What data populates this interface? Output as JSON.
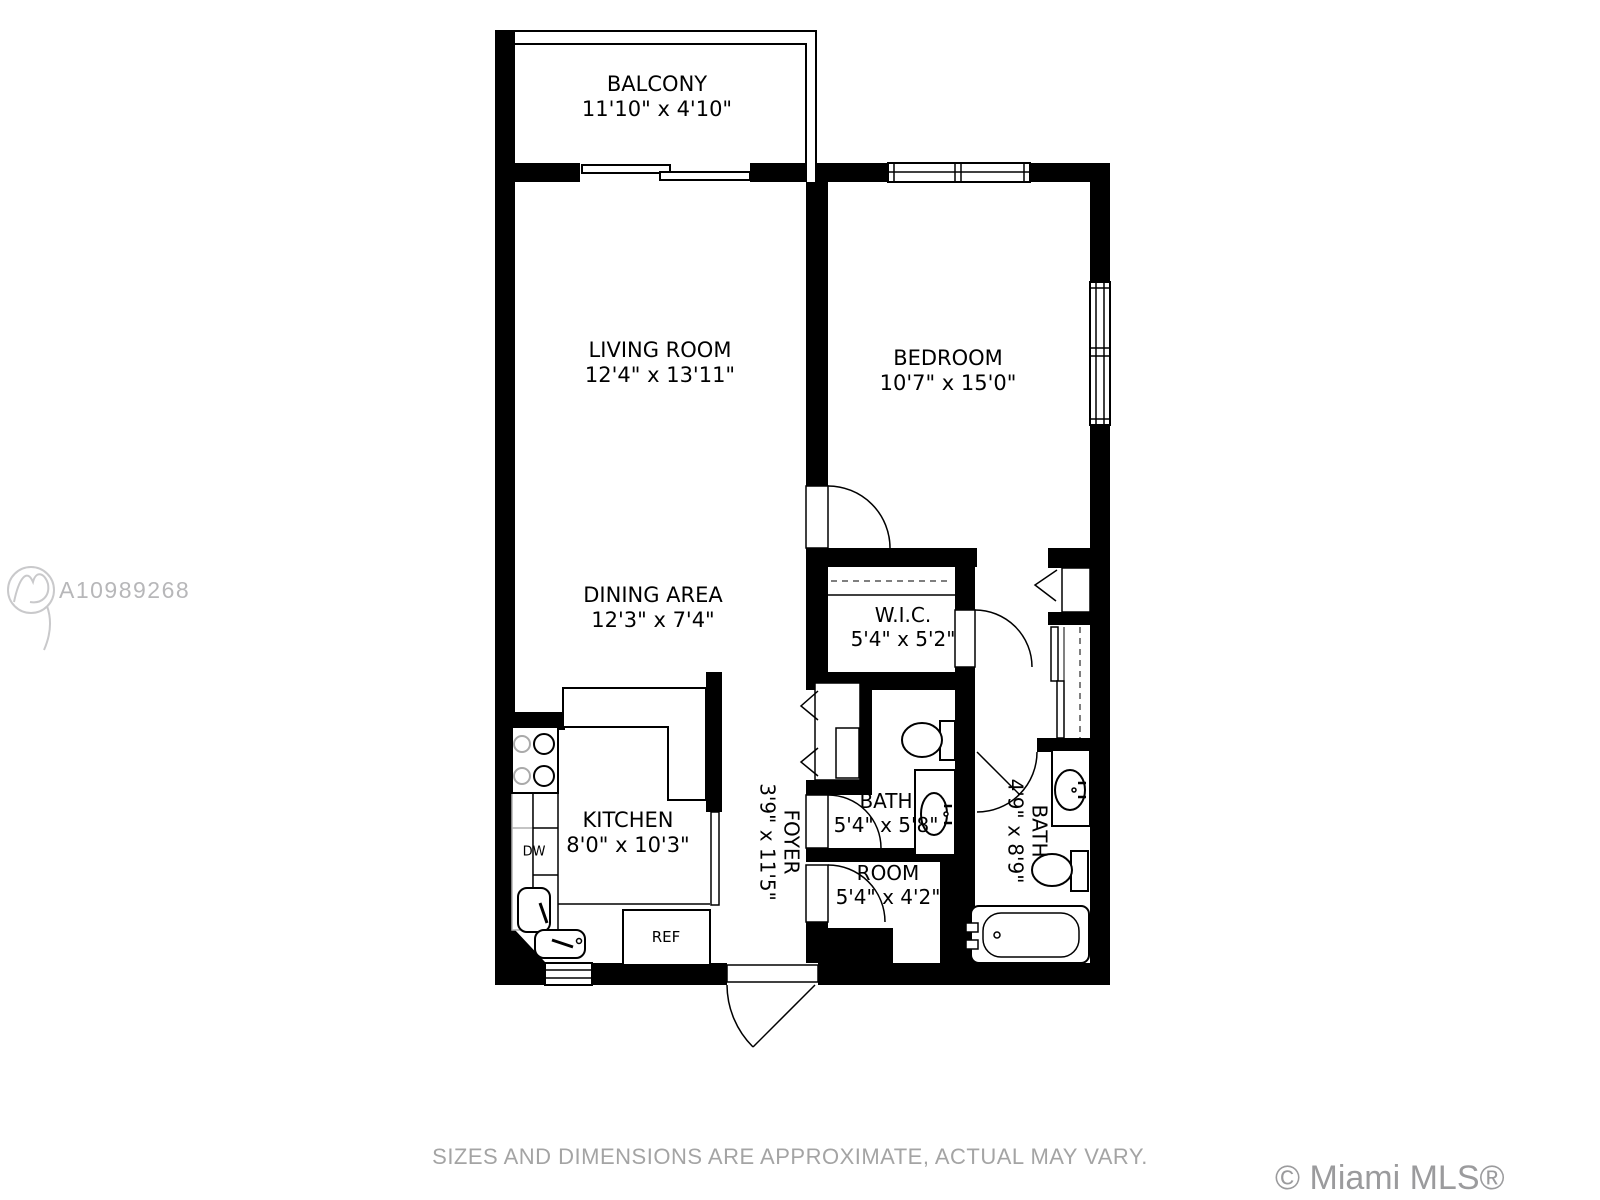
{
  "plan": {
    "rooms": [
      {
        "id": "balcony",
        "name": "BALCONY",
        "dims": "11'10\" x 4'10\""
      },
      {
        "id": "living-room",
        "name": "LIVING ROOM",
        "dims": "12'4\" x 13'11\""
      },
      {
        "id": "bedroom",
        "name": "BEDROOM",
        "dims": "10'7\" x 15'0\""
      },
      {
        "id": "dining-area",
        "name": "DINING AREA",
        "dims": "12'3\" x 7'4\""
      },
      {
        "id": "wic",
        "name": "W.I.C.",
        "dims": "5'4\" x 5'2\""
      },
      {
        "id": "kitchen",
        "name": "KITCHEN",
        "dims": "8'0\" x 10'3\""
      },
      {
        "id": "foyer",
        "name": "FOYER",
        "dims": "3'9\" x 11'5\"",
        "rotated": true
      },
      {
        "id": "bath-1",
        "name": "BATH",
        "dims": "5'4\" x 5'8\""
      },
      {
        "id": "bath-2",
        "name": "BATH",
        "dims": "4'9\" x 8'9\"",
        "rotated": true
      },
      {
        "id": "utility-room",
        "name": "ROOM",
        "dims": "5'4\" x 4'2\""
      }
    ],
    "fixture_labels": {
      "dishwasher": "DW",
      "refrigerator": "REF"
    }
  },
  "watermark": {
    "listing_id": "A10989268"
  },
  "footer": {
    "disclaimer": "SIZES AND DIMENSIONS ARE APPROXIMATE, ACTUAL MAY VARY.",
    "copyright": "© Miami MLS® 01/2021"
  },
  "colors": {
    "walls": "#000000",
    "label_text": "#000000",
    "watermark_text": "#b7b7b9",
    "disclaimer_text": "#a4a4a4",
    "copyright_text": "#9b9b9d"
  }
}
